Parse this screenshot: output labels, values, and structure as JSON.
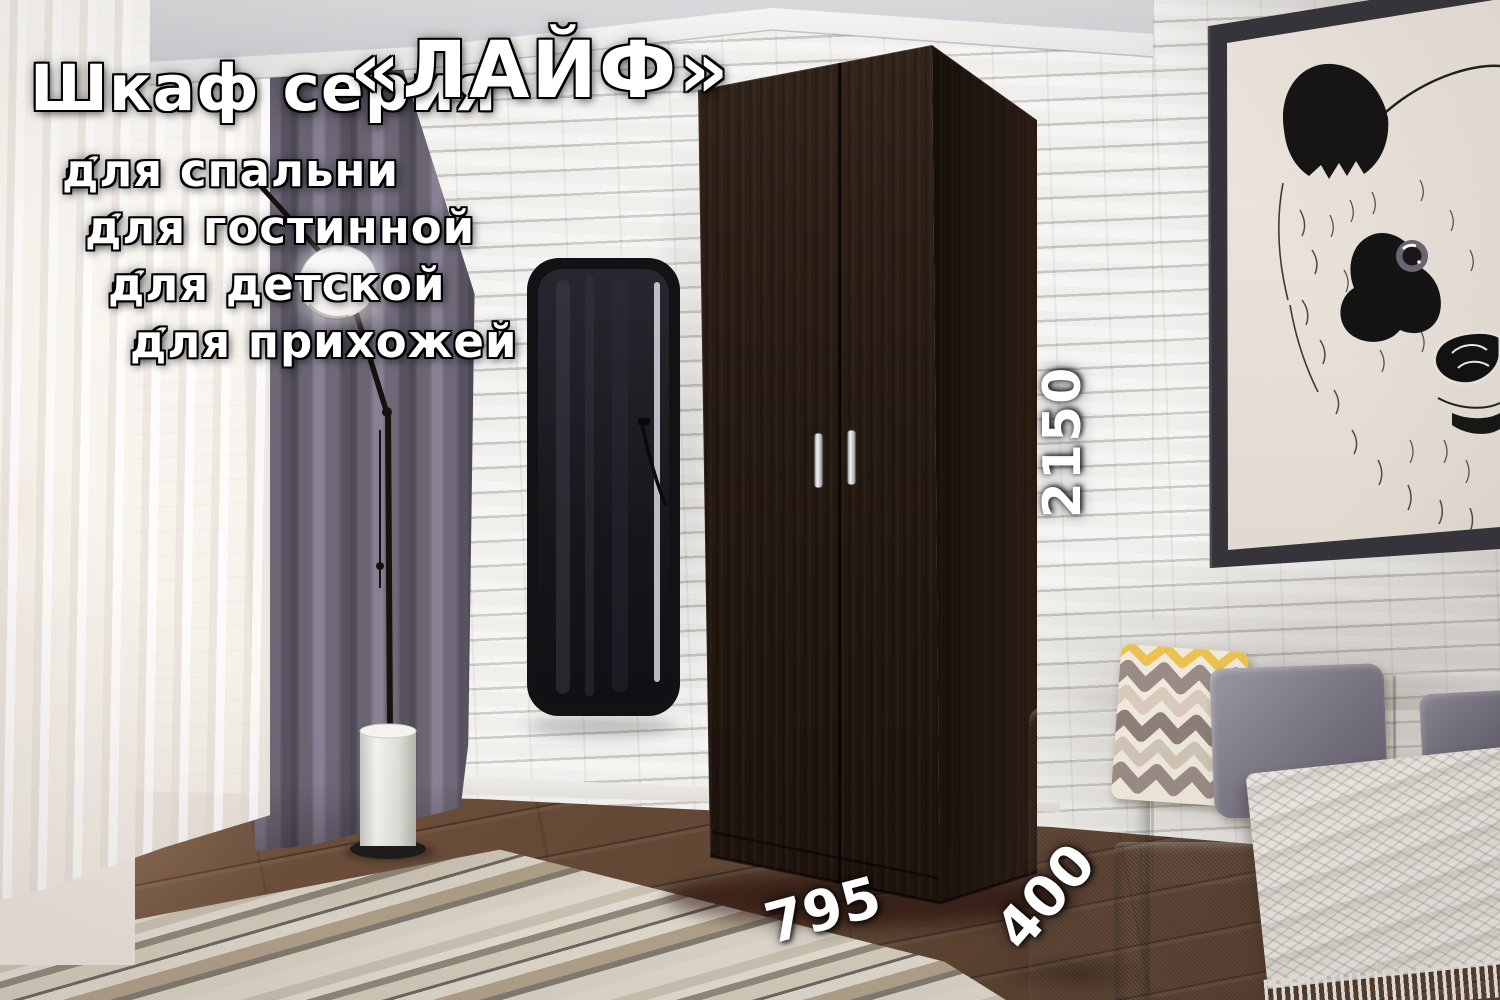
{
  "overlay": {
    "title": {
      "prefix": "Шкаф серия",
      "series": "«ЛАЙФ»"
    },
    "check_glyph": "✔",
    "features": [
      {
        "label": "для спальни"
      },
      {
        "label": "для гостинной"
      },
      {
        "label": "для детской"
      },
      {
        "label": "для прихожей"
      }
    ],
    "dimensions": {
      "height": "2150",
      "width": "795",
      "depth": "400"
    }
  },
  "palette": {
    "text": "#ffffff",
    "text_outline": "#000000",
    "wardrobe_wood": "#241810",
    "curtain": "#6e6876",
    "sofa": "#a6964e",
    "wall_brick": "#ebe8e4",
    "floor_wood": "#63483577",
    "mirror_frame": "#141416",
    "picture_frame": "#35343a"
  }
}
